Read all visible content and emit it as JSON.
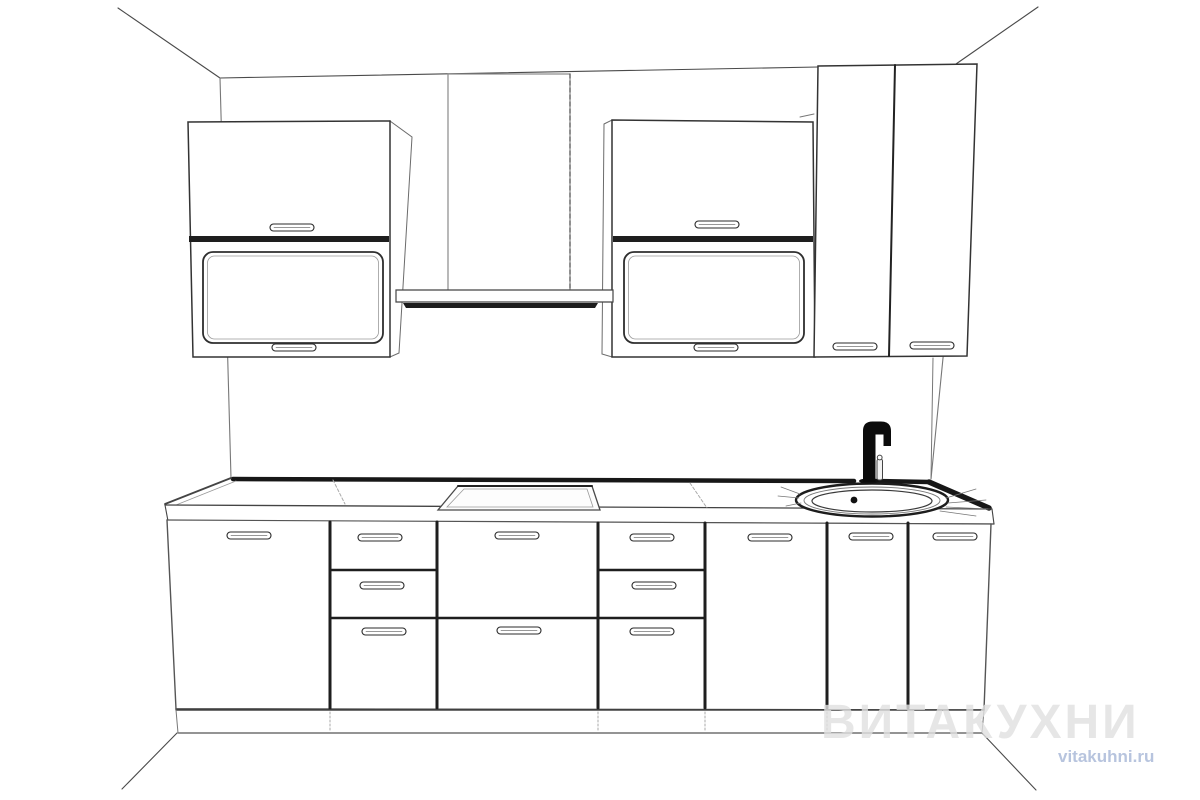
{
  "watermark": {
    "brand": "ВИТАКУХНИ",
    "site": "vitakuhni.ru"
  },
  "palette": {
    "line": "#4a4a4a",
    "line_dark": "#171717",
    "line_mid": "#6b6b6b",
    "line_light": "#9a9a9a",
    "paper": "#ffffff",
    "faucet": "#0b0b0b",
    "wm_brand": "rgba(224,224,224,0.8)",
    "wm_site": "#b7c4de"
  },
  "scene": {
    "type": "kitchen-line-render",
    "view": "one-point perspective, front elevation of straight kitchen",
    "upper_row": [
      {
        "id": "wall-cabinet-left",
        "fronts": [
          "flip-up solid door",
          "flip-up framed glass door"
        ],
        "handles": 2
      },
      {
        "id": "hood",
        "parts": [
          "chimney duct",
          "flat canopy"
        ]
      },
      {
        "id": "wall-cabinet-right",
        "fronts": [
          "flip-up solid door",
          "flip-up framed glass door"
        ],
        "handles": 2
      },
      {
        "id": "tall-wall-cabinet",
        "fronts": [
          "hinged door left",
          "hinged door right"
        ],
        "handles": 2
      }
    ],
    "base_row": [
      {
        "id": "base-door-left",
        "front": "single door",
        "handles": 1
      },
      {
        "id": "drawer-unit-left",
        "front": "3 drawers",
        "handles": 3
      },
      {
        "id": "pot-drawer-unit",
        "front": "2 deep drawers",
        "handles": 2,
        "worktop_above": "cooktop"
      },
      {
        "id": "drawer-unit-right",
        "front": "3 drawers",
        "handles": 3
      },
      {
        "id": "base-door-wide",
        "front": "single door",
        "handles": 1
      },
      {
        "id": "sink-base",
        "front": "2 doors",
        "handles": 2,
        "worktop_above": "sink"
      }
    ],
    "worktop": {
      "cooktop": "flush rectangular hob",
      "sink": "oval inset sink with drain",
      "faucet": "black single-lever mixer tap"
    }
  }
}
